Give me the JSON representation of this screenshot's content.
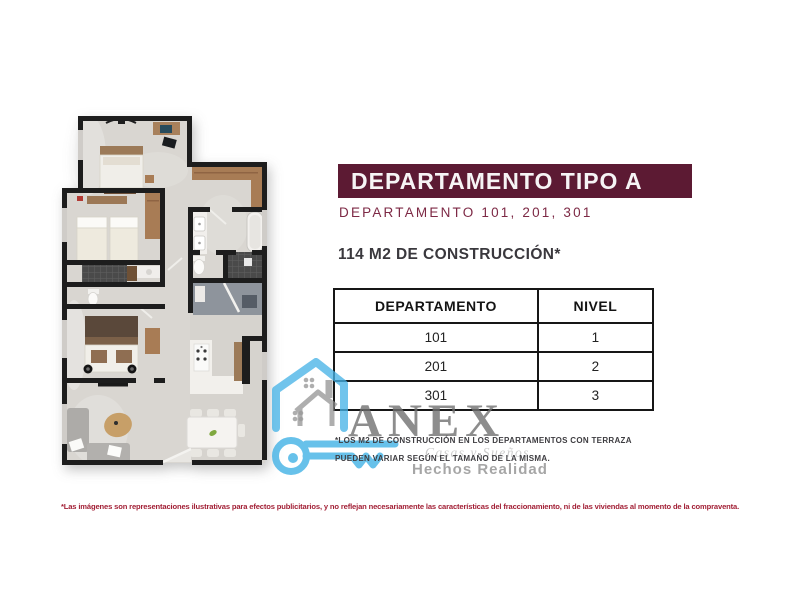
{
  "header": {
    "banner_title": "DEPARTAMENTO TIPO A",
    "banner_bg": "#5c1a33",
    "subtitle": "DEPARTAMENTO 101, 201, 301",
    "subtitle_color": "#7d2945",
    "construction": "114 M2 DE CONSTRUCCIÓN*"
  },
  "table": {
    "headers": [
      "DEPARTAMENTO",
      "NIVEL"
    ],
    "rows": [
      [
        "101",
        "1"
      ],
      [
        "201",
        "2"
      ],
      [
        "301",
        "3"
      ]
    ]
  },
  "footnote": {
    "line1": "*LOS M2 DE CONSTRUCCIÓN EN LOS DEPARTAMENTOS CON TERRAZA",
    "line2": "PUEDEN VARIAR SEGÚN EL TAMAÑO DE LA MISMA."
  },
  "legal": "*Las imágenes son representaciones ilustrativas para efectos publicitarios, y no reflejan necesariamente las características del fraccionamiento, ni de las viviendas al momento de la compraventa.",
  "watermark": {
    "brand": "ANEX",
    "tagline1": "Casas y Sueños",
    "tagline2": "Hechos Realidad",
    "blue": "#45b3e6",
    "gray": "#8a8a8a"
  },
  "floorplan": {
    "description": "Top-down 3D render of apartment type A: two bedrooms, master bedroom, two bathrooms, hallway closets, kitchen with island, dining table for six, living area, entry"
  }
}
